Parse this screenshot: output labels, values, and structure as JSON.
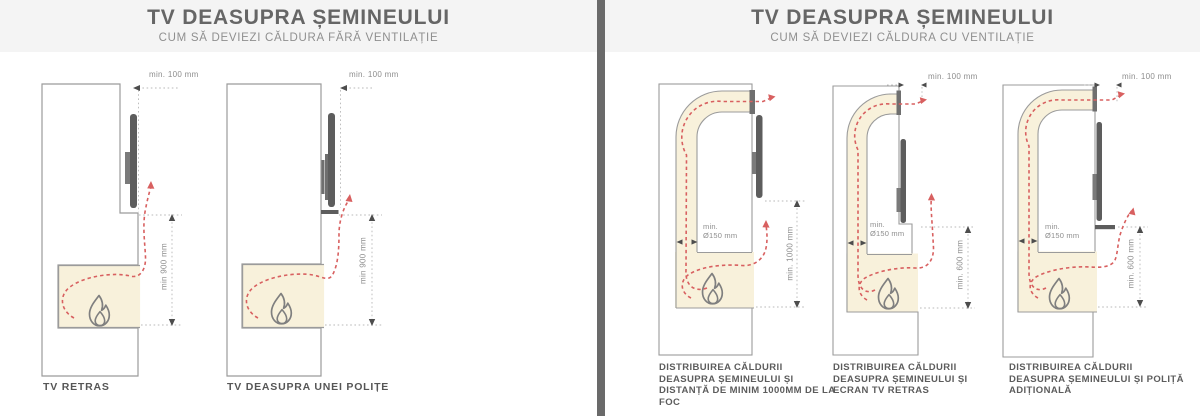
{
  "panels": {
    "left": {
      "title": "TV DEASUPRA ȘEMINEULUI",
      "subtitle": "CUM SĂ DEVIEZI CĂLDURA FĂRĂ VENTILAȚIE",
      "diagrams": [
        {
          "caption": "TV RETRAS",
          "dim_top": "min. 100 mm",
          "dim_side": "min 900 mm"
        },
        {
          "caption": "TV DEASUPRA UNEI POLIȚE",
          "dim_top": "min. 100 mm",
          "dim_side": "min 900 mm"
        }
      ]
    },
    "right": {
      "title": "TV DEASUPRA ȘEMINEULUI",
      "subtitle": "CUM SĂ DEVIEZI CĂLDURA CU VENTILAȚIE",
      "diagrams": [
        {
          "caption": "DISTRIBUIREA CĂLDURII DEASUPRA ȘEMINEULUI ȘI DISTANȚĂ DE MINIM 1000MM DE LA FOC",
          "dim_side": "min. 1000 mm",
          "duct_line1": "min.",
          "duct_line2": "Ø150 mm"
        },
        {
          "caption": "DISTRIBUIREA CĂLDURII DEASUPRA ȘEMINEULUI ȘI ECRAN TV RETRAS",
          "dim_top": "min. 100 mm",
          "dim_side": "min. 600 mm",
          "duct_line1": "min.",
          "duct_line2": "Ø150 mm"
        },
        {
          "caption": "DISTRIBUIREA CĂLDURII DEASUPRA ȘEMINEULUI ȘI POLIȚĂ ADIȚIONALĂ",
          "dim_top": "min. 100 mm",
          "dim_side": "min. 600 mm",
          "duct_line1": "min.",
          "duct_line2": "Ø150 mm"
        }
      ]
    }
  },
  "colors": {
    "header_bg": "#f4f4f4",
    "divider_gray": "#6a6a6a",
    "title_gray": "#666666",
    "wall_stroke": "#9b9b9b",
    "firebox_beige": "#f8f1db",
    "heat_red": "#d86060",
    "tv_dark": "#5d5d5d"
  }
}
